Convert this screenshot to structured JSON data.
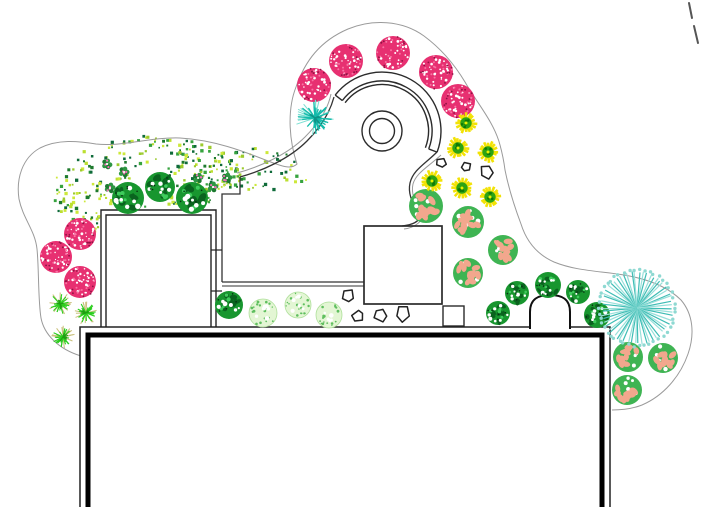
{
  "canvas": {
    "width": 705,
    "height": 507,
    "background": "#ffffff"
  },
  "palette": {
    "bed_line": "#9a9a9a",
    "structure_line": "#2b2b2b",
    "wall_black": "#000000",
    "pink_tree": "#e73071",
    "pink_tree_dark": "#8f1243",
    "pink_tree_light": "#f973a3",
    "green_shrub": "#18962f",
    "green_shrub_dark": "#0a631f",
    "green_shrub_light": "#3ecb5c",
    "pale_shrub": "#e3f6d4",
    "pale_shrub_dot": "#5fbf5f",
    "salmon_base": "#3fb453",
    "salmon_blob": "#f2a78d",
    "teal_main": "#14bbab",
    "teal_light": "#7adfd2",
    "teal_radial_a": "#3fbdb5",
    "teal_radial_b": "#98e0da",
    "teal_fringe": "#8fd9d2",
    "star_yellow": "#f2e205",
    "star_green": "#2da414",
    "star_green_dark": "#0f7a07",
    "grass_green": "#2cce1e",
    "grass_tan": "#c9c07c",
    "clover_green": "#2e9643",
    "clover_pink": "#ed6fb4",
    "dot_mass_colors": [
      "#1e7a2e",
      "#37a33f",
      "#9ccb2d",
      "#cde83a",
      "#0f6b3a",
      "#bcdf30"
    ]
  },
  "plants": {
    "pink_trees": [
      {
        "x": 314,
        "y": 85,
        "r": 17
      },
      {
        "x": 346,
        "y": 61,
        "r": 17
      },
      {
        "x": 393,
        "y": 53,
        "r": 17
      },
      {
        "x": 436,
        "y": 72,
        "r": 17
      },
      {
        "x": 458,
        "y": 101,
        "r": 17
      },
      {
        "x": 80,
        "y": 234,
        "r": 16
      },
      {
        "x": 56,
        "y": 257,
        "r": 16
      },
      {
        "x": 80,
        "y": 282,
        "r": 16
      }
    ],
    "green_shrubs": [
      {
        "x": 128,
        "y": 198,
        "r": 16
      },
      {
        "x": 160,
        "y": 187,
        "r": 15
      },
      {
        "x": 192,
        "y": 198,
        "r": 16
      },
      {
        "x": 229,
        "y": 305,
        "r": 14
      },
      {
        "x": 498,
        "y": 313,
        "r": 12
      },
      {
        "x": 517,
        "y": 293,
        "r": 12
      },
      {
        "x": 548,
        "y": 285,
        "r": 13
      },
      {
        "x": 578,
        "y": 292,
        "r": 12
      },
      {
        "x": 597,
        "y": 315,
        "r": 13
      }
    ],
    "pale_shrubs": [
      {
        "x": 263,
        "y": 313,
        "r": 14
      },
      {
        "x": 298,
        "y": 305,
        "r": 13
      },
      {
        "x": 329,
        "y": 315,
        "r": 13
      }
    ],
    "salmon_shrubs": [
      {
        "x": 426,
        "y": 206,
        "r": 17
      },
      {
        "x": 468,
        "y": 222,
        "r": 16
      },
      {
        "x": 503,
        "y": 250,
        "r": 15
      },
      {
        "x": 468,
        "y": 273,
        "r": 15
      },
      {
        "x": 628,
        "y": 357,
        "r": 15
      },
      {
        "x": 663,
        "y": 358,
        "r": 15
      },
      {
        "x": 627,
        "y": 390,
        "r": 15
      }
    ],
    "teal_stars": [
      {
        "x": 315,
        "y": 118,
        "r": 17
      }
    ],
    "teal_radials": [
      {
        "x": 637,
        "y": 308,
        "r": 37
      }
    ],
    "yellow_stars": [
      {
        "x": 466,
        "y": 123,
        "r": 11
      },
      {
        "x": 458,
        "y": 148,
        "r": 11
      },
      {
        "x": 488,
        "y": 152,
        "r": 11
      },
      {
        "x": 432,
        "y": 181,
        "r": 11
      },
      {
        "x": 462,
        "y": 188,
        "r": 11
      },
      {
        "x": 490,
        "y": 197,
        "r": 11
      }
    ],
    "grass_tufts": [
      {
        "x": 60,
        "y": 304,
        "r": 11
      },
      {
        "x": 86,
        "y": 313,
        "r": 11
      },
      {
        "x": 63,
        "y": 337,
        "r": 11
      }
    ],
    "clovers": [
      {
        "x": 107,
        "y": 164
      },
      {
        "x": 124,
        "y": 172
      },
      {
        "x": 110,
        "y": 188
      },
      {
        "x": 198,
        "y": 178
      },
      {
        "x": 213,
        "y": 187
      },
      {
        "x": 227,
        "y": 178
      }
    ],
    "stones": [
      {
        "x": 441,
        "y": 163,
        "r": 5,
        "rot": 10
      },
      {
        "x": 466,
        "y": 167,
        "r": 5,
        "rot": 40
      },
      {
        "x": 487,
        "y": 172,
        "r": 7,
        "rot": 0
      },
      {
        "x": 348,
        "y": 296,
        "r": 7,
        "rot": 15
      },
      {
        "x": 358,
        "y": 316,
        "r": 6,
        "rot": 50
      },
      {
        "x": 381,
        "y": 315,
        "r": 7,
        "rot": 80
      },
      {
        "x": 403,
        "y": 314,
        "r": 8,
        "rot": 20
      }
    ]
  },
  "dot_mass": {
    "ellipses": [
      {
        "cx": 150,
        "cy": 192,
        "rx": 100,
        "ry": 56
      },
      {
        "cx": 250,
        "cy": 175,
        "rx": 58,
        "ry": 27
      }
    ],
    "holes": [
      {
        "cx": 150,
        "cy": 184,
        "r": 25
      },
      {
        "cx": 200,
        "cy": 212,
        "r": 15
      },
      {
        "cx": 104,
        "cy": 171,
        "r": 12
      },
      {
        "cx": 172,
        "cy": 243,
        "r": 13
      },
      {
        "cx": 252,
        "cy": 170,
        "r": 10
      }
    ],
    "exclude_rects": [
      {
        "x": 99,
        "y": 207,
        "w": 120,
        "h": 60
      },
      {
        "x": 218,
        "y": 190,
        "w": 130,
        "h": 80
      }
    ],
    "count": 320
  },
  "structures": {
    "paths": [
      {
        "name": "bed-boundary",
        "d": "M 81,356 C 58,349 44,334 41,318 C 38,300 39,268 37,249 C 35,230 23,219 19,199 C 16,179 22,158 40,148 C 58,139 78,141 96,144 C 122,147 150,137 180,138 C 214,140 243,151 268,161 C 281,166 291,170 297,164 C 289,140 287,110 296,87 C 305,61 320,41 348,29 C 372,19 402,20 424,36 C 443,50 456,67 465,82 C 477,103 494,122 500,145 C 503,156 504,162 505,170 C 509,190 515,208 521,224 C 526,240 536,254 554,262 C 576,271 600,271 624,275 C 648,279 668,287 681,300 C 693,314 695,334 688,354 C 680,377 663,396 642,405 C 632,409 620,410 612,410",
        "stroke": "#9a9a9a",
        "w": 1
      },
      {
        "name": "patio-arc-outer",
        "d": "M 237,173 C 259,167 287,155 305,137 C 319,123 328,109 331,94",
        "stroke": "#9a9a9a",
        "w": 1
      },
      {
        "name": "patio-arc-inner",
        "d": "M 240,177 C 262,171 289,159 307,141 C 321,127 330,112 334,97",
        "stroke": "#333333",
        "w": 1.3
      },
      {
        "name": "patio-left-outline",
        "d": "M 240,177 L 240,194 L 222,194 L 222,282",
        "stroke": "#333333",
        "w": 1.3
      },
      {
        "name": "patio-bottom-line-1",
        "d": "M 222,282 L 364,282",
        "stroke": "#333333",
        "w": 1.3
      },
      {
        "name": "patio-bottom-line-2",
        "d": "M 222,286 L 364,286",
        "stroke": "#333333",
        "w": 1.1
      },
      {
        "name": "walk-curve-inner",
        "d": "M 437,152 C 425,164 413,170 410,183 C 407,197 416,207 419,215 C 421,222 411,225 402,226",
        "stroke": "#333333",
        "w": 1.3
      },
      {
        "name": "walk-curve-outer",
        "d": "M 441,155 C 428,167 416,173 413,184 C 410,197 419,207 422,214 C 424,221 414,228 404,229",
        "stroke": "#9a9a9a",
        "w": 1
      },
      {
        "name": "shed-outer-wall",
        "d": "M 101,328 L 101,210 L 216,210 L 216,328",
        "stroke": "#222222",
        "w": 1.4
      },
      {
        "name": "shed-inner-wall",
        "d": "M 106,328 L 106,215 L 211,215 L 211,328",
        "stroke": "#222222",
        "w": 1.4
      },
      {
        "name": "shed-connector-1",
        "d": "M 211,250 L 222,250",
        "stroke": "#222222",
        "w": 1.2
      },
      {
        "name": "shed-connector-2",
        "d": "M 211,291 L 222,291",
        "stroke": "#222222",
        "w": 1.2
      }
    ],
    "arch": {
      "name": "arch-alcove",
      "d": "M 530,329 L 530,312 C 530,299 538,295 550,295 C 562,295 570,299 570,312 L 570,329",
      "stroke": "#111111",
      "w": 2,
      "fill": "#ffffff"
    },
    "band": {
      "cx": 382,
      "cy": 131,
      "rOuter": 59,
      "rInner": 50,
      "rInner2": 46.5,
      "a0": 217.5,
      "a1": 381,
      "stroke": "#2b2b2b",
      "w": 1.4
    },
    "feature_circles": [
      {
        "cx": 382,
        "cy": 131,
        "r": 20
      },
      {
        "cx": 382,
        "cy": 131,
        "r": 12.5
      }
    ],
    "beds": [
      {
        "name": "square-bed",
        "x": 364,
        "y": 226,
        "w": 78,
        "h": 78,
        "sw": 1.7
      },
      {
        "name": "small-square-bed",
        "x": 443,
        "y": 306,
        "w": 21,
        "h": 20,
        "sw": 1.4
      }
    ],
    "building": {
      "outer": {
        "x": 80,
        "y": 327,
        "w": 530,
        "h": 188,
        "sw": 1.5
      },
      "inner": {
        "x": 88,
        "y": 335,
        "w": 514,
        "h": 180,
        "sw": 5
      }
    },
    "corner_marks": [
      {
        "x1": 689,
        "y1": 3,
        "x2": 692,
        "y2": 18
      },
      {
        "x1": 694,
        "y1": 26,
        "x2": 698,
        "y2": 43
      }
    ]
  }
}
